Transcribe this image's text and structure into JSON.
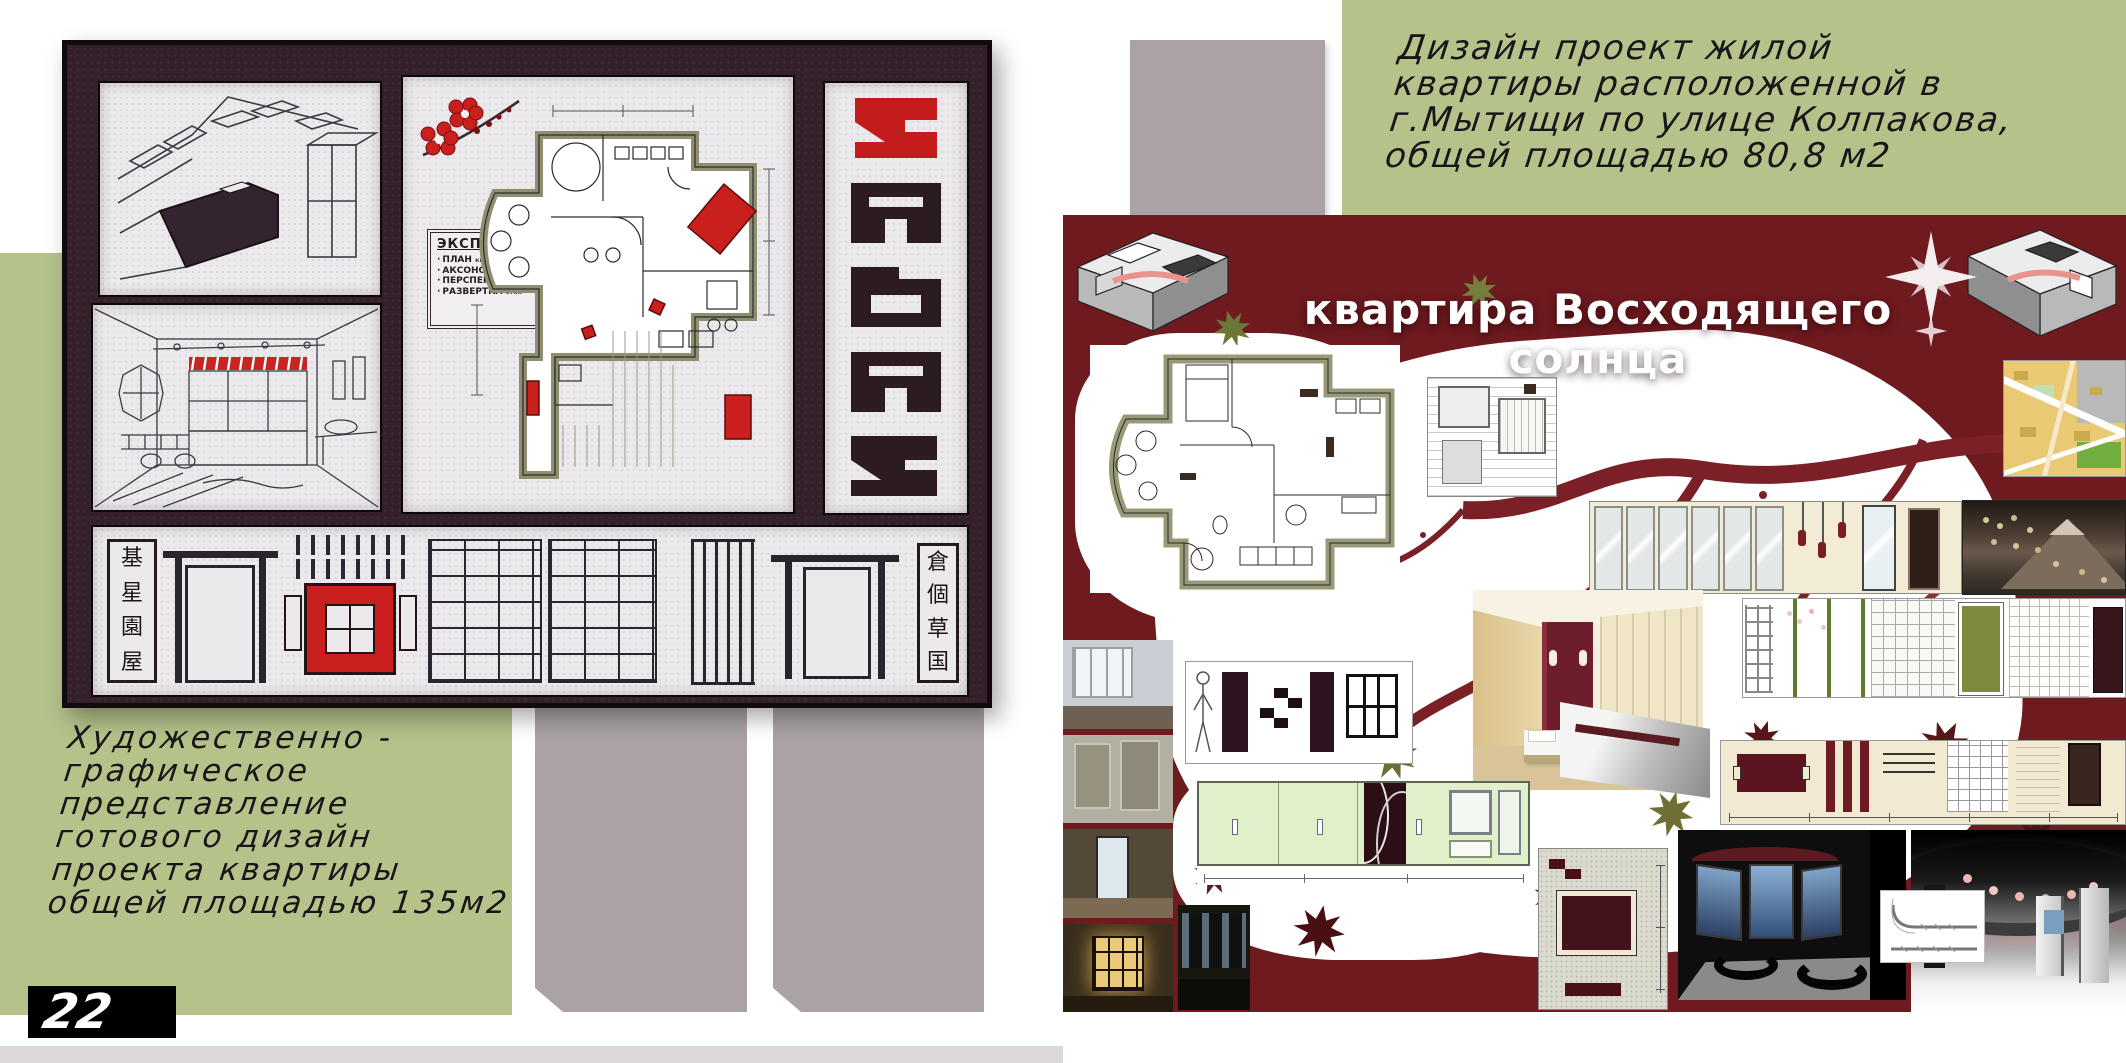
{
  "colors": {
    "green_panel": "#b5c28a",
    "gray_block": "#aaa2a6",
    "collage_maroon": "#6e1a1f",
    "board_bg": "#33202a",
    "accent_red": "#c9201d",
    "bottom_bar": "#dcd8da"
  },
  "left_page": {
    "caption_lines": [
      "Художественно -",
      "графическое",
      "представление",
      "готового дизайн",
      "проекта квартиры",
      "общей площадью 135м2"
    ],
    "page_number": "22",
    "board": {
      "explication": {
        "title": "ЭКСПЛИКАЦИЯ",
        "items": [
          {
            "label": "ПЛАН",
            "sub": "квартиры № 15"
          },
          {
            "label": "АКСОНОМЕТРИЯ",
            "sub": "кухни"
          },
          {
            "label": "ПЕРСПЕКТИВА",
            "sub": "ван. комнаты"
          },
          {
            "label": "РАЗВЕРТКА",
            "sub": "стен"
          }
        ]
      },
      "left_sign": [
        "基",
        "星",
        "園",
        "屋"
      ],
      "right_sign": [
        "倉",
        "個",
        "草",
        "国"
      ]
    }
  },
  "right_page": {
    "caption_lines": [
      "Дизайн проект жилой",
      "квартиры расположенной в",
      "г.Мытищи по улице Колпакова,",
      "общей площадью 80,8 м2"
    ],
    "collage_title": "квартира Восходящего солнца"
  }
}
